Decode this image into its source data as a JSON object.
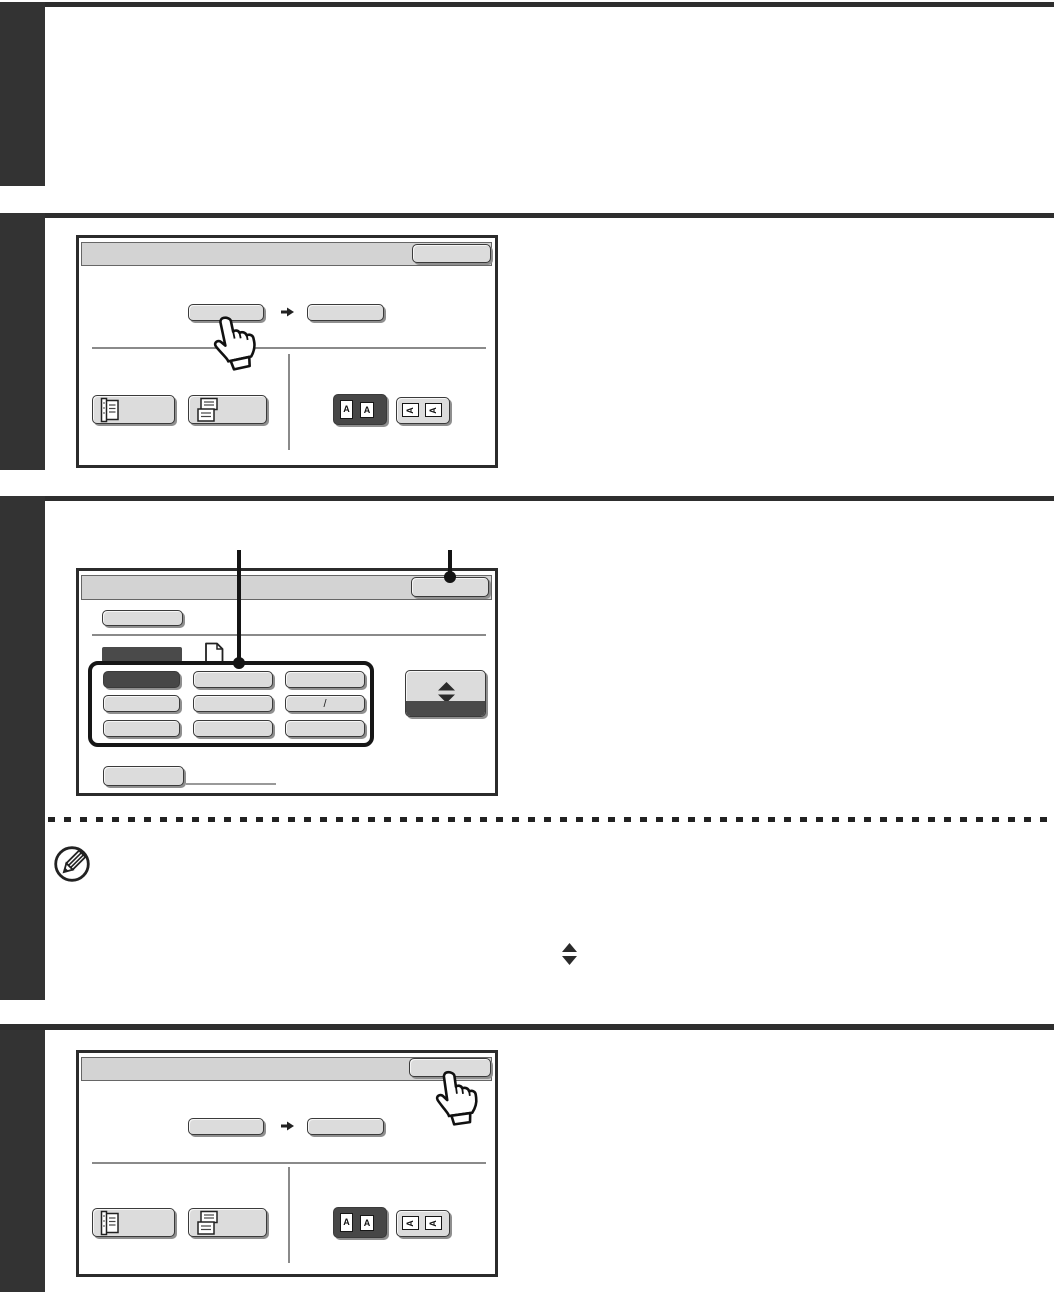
{
  "document": {
    "kind": "operation-manual page with touch-panel figures",
    "note_marker_icon": "pencil-circle-icon",
    "inline_symbol_icon": "up-down-diamond-icon"
  },
  "colors": {
    "step_bar": "#333333",
    "section_rule": "#2e2e2e",
    "panel_border": "#2b2b2b",
    "header_bg": "#d3d3d3",
    "button_bg": "#dcdcdc",
    "dark_fill": "#474747",
    "callout": "#141414"
  },
  "screen1": {
    "name": "original size select screen",
    "ok_button_label": "",
    "left_size_button_label": "",
    "right_size_button_label": "",
    "icon_button_1_label": "",
    "icon_button_2_label": "",
    "orientation_letter": "A",
    "cursor_icon": "pointing-hand-icon"
  },
  "screen2": {
    "name": "size input screen",
    "ok_button_label": "",
    "menu_button_label": "",
    "tab_label": "",
    "page_icon": "page-icon",
    "grid_labels": [
      "",
      "",
      "",
      "",
      "",
      "/",
      "",
      "",
      ""
    ],
    "scroll_button_icon": "up-down-diamond-icon",
    "footer_button_label": ""
  },
  "screen3": {
    "name": "original size select screen (OK pressed)",
    "ok_button_label": "",
    "left_size_button_label": "",
    "right_size_button_label": "",
    "icon_button_1_label": "",
    "icon_button_2_label": "",
    "orientation_letter": "A",
    "cursor_icon": "pointing-hand-icon"
  }
}
